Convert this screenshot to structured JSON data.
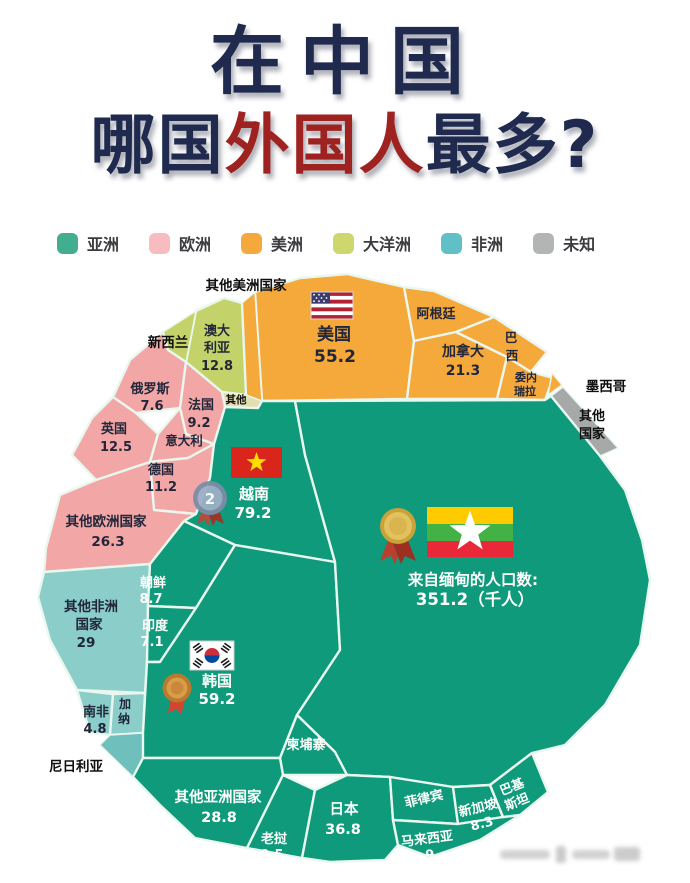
{
  "title": {
    "line1": "在中国",
    "line2_prefix": "哪国",
    "line2_highlight": "外国人",
    "line2_suffix": "最多?"
  },
  "colors": {
    "title_navy": "#1f2a4e",
    "title_red": "#9e2320",
    "asia": "#0f9a7c",
    "europe": "#f2a7a6",
    "americas": "#f4a93a",
    "oceania": "#c3d36a",
    "africa": "#8acdc9",
    "africa_dark": "#6fc0bd",
    "unknown": "#a6a9a8",
    "other_small": "#e3dfb0",
    "cell_border": "#e9f7ef"
  },
  "legend": {
    "items": [
      {
        "label": "亚洲",
        "color": "#43ae8f"
      },
      {
        "label": "欧洲",
        "color": "#f6bcc0"
      },
      {
        "label": "美洲",
        "color": "#f4a93a"
      },
      {
        "label": "大洋洲",
        "color": "#cdd76e"
      },
      {
        "label": "非洲",
        "color": "#5fc0c8"
      },
      {
        "label": "未知",
        "color": "#b2b5b4"
      }
    ]
  },
  "map": {
    "cells": {
      "usa": {
        "name": "美国",
        "value": "55.2"
      },
      "argentina": {
        "name": "阿根廷"
      },
      "canada": {
        "name": "加拿大",
        "value": "21.3"
      },
      "brazil": {
        "lines": [
          "巴",
          "西"
        ]
      },
      "venezuela": {
        "lines": [
          "委内",
          "瑞拉"
        ]
      },
      "australia": {
        "lines": [
          "澳大",
          "利亚"
        ],
        "value": "12.8"
      },
      "other_small": {
        "name": "其他"
      },
      "russia": {
        "name": "俄罗斯",
        "value": "7.6"
      },
      "france": {
        "name": "法国",
        "value": "9.2"
      },
      "uk": {
        "name": "英国",
        "value": "12.5"
      },
      "italy": {
        "name": "意大利"
      },
      "germany": {
        "name": "德国",
        "value": "11.2"
      },
      "other_europe": {
        "name": "其他欧洲国家",
        "value": "26.3"
      },
      "other_africa": {
        "lines": [
          "其他非洲",
          "国家"
        ],
        "value": "29"
      },
      "south_africa": {
        "name": "南非",
        "value": "4.8"
      },
      "ghana": {
        "lines": [
          "加",
          "纳"
        ]
      },
      "north_korea": {
        "name": "朝鲜",
        "value": "8.7"
      },
      "india": {
        "name": "印度",
        "value": "7.1"
      },
      "vietnam": {
        "name": "越南",
        "value": "79.2"
      },
      "korea": {
        "name": "韩国",
        "value": "59.2"
      },
      "cambodia": {
        "name": "柬埔寨"
      },
      "other_asia": {
        "name": "其他亚洲国家",
        "value": "28.8"
      },
      "laos": {
        "name": "老挝",
        "value": "9.5"
      },
      "japan": {
        "name": "日本",
        "value": "36.8"
      },
      "philippines": {
        "name": "菲律宾"
      },
      "singapore": {
        "name": "新加坡",
        "value": "8.3"
      },
      "malaysia": {
        "name": "马来西亚",
        "value": "9"
      },
      "pakistan": {
        "lines": [
          "巴基",
          "斯坦"
        ]
      },
      "other_countries": {
        "lines": [
          "其他",
          "国家"
        ]
      }
    },
    "outside_labels": {
      "other_americas": "其他美洲国家",
      "new_zealand": "新西兰",
      "mexico": "墨西哥",
      "nigeria": "尼日利亚"
    },
    "myanmar": {
      "caption_line1": "来自缅甸的人口数:",
      "caption_line2": "351.2（千人）"
    },
    "medals": {
      "silver_rank": "2"
    }
  },
  "chart_data": {
    "type": "voronoi-treemap",
    "title": "在中国 哪国外国人最多?",
    "unit": "千人",
    "annotation": "来自缅甸的人口数: 351.2（千人）",
    "legend_position": "top",
    "groups": [
      {
        "name": "亚洲",
        "color": "#0f9a7c",
        "items": [
          {
            "label": "缅甸",
            "value": 351.2
          },
          {
            "label": "越南",
            "value": 79.2
          },
          {
            "label": "韩国",
            "value": 59.2
          },
          {
            "label": "日本",
            "value": 36.8
          },
          {
            "label": "其他亚洲国家",
            "value": 28.8
          },
          {
            "label": "老挝",
            "value": 9.5
          },
          {
            "label": "马来西亚",
            "value": 9
          },
          {
            "label": "朝鲜",
            "value": 8.7
          },
          {
            "label": "新加坡",
            "value": 8.3
          },
          {
            "label": "印度",
            "value": 7.1
          },
          {
            "label": "柬埔寨",
            "value": null
          },
          {
            "label": "菲律宾",
            "value": null
          },
          {
            "label": "巴基斯坦",
            "value": null
          }
        ]
      },
      {
        "name": "欧洲",
        "color": "#f2a7a6",
        "items": [
          {
            "label": "其他欧洲国家",
            "value": 26.3
          },
          {
            "label": "英国",
            "value": 12.5
          },
          {
            "label": "德国",
            "value": 11.2
          },
          {
            "label": "法国",
            "value": 9.2
          },
          {
            "label": "俄罗斯",
            "value": 7.6
          },
          {
            "label": "意大利",
            "value": null
          }
        ]
      },
      {
        "name": "美洲",
        "color": "#f4a93a",
        "items": [
          {
            "label": "美国",
            "value": 55.2
          },
          {
            "label": "加拿大",
            "value": 21.3
          },
          {
            "label": "阿根廷",
            "value": null
          },
          {
            "label": "巴西",
            "value": null
          },
          {
            "label": "委内瑞拉",
            "value": null
          },
          {
            "label": "墨西哥",
            "value": null
          },
          {
            "label": "其他美洲国家",
            "value": null
          }
        ]
      },
      {
        "name": "大洋洲",
        "color": "#c3d36a",
        "items": [
          {
            "label": "澳大利亚",
            "value": 12.8
          },
          {
            "label": "新西兰",
            "value": null
          }
        ]
      },
      {
        "name": "非洲",
        "color": "#8acdc9",
        "items": [
          {
            "label": "其他非洲国家",
            "value": 29
          },
          {
            "label": "南非",
            "value": 4.8
          },
          {
            "label": "加纳",
            "value": null
          },
          {
            "label": "尼日利亚",
            "value": null
          }
        ]
      },
      {
        "name": "未知",
        "color": "#a6a9a8",
        "items": [
          {
            "label": "其他国家",
            "value": null
          },
          {
            "label": "其他",
            "value": null
          }
        ]
      }
    ]
  }
}
